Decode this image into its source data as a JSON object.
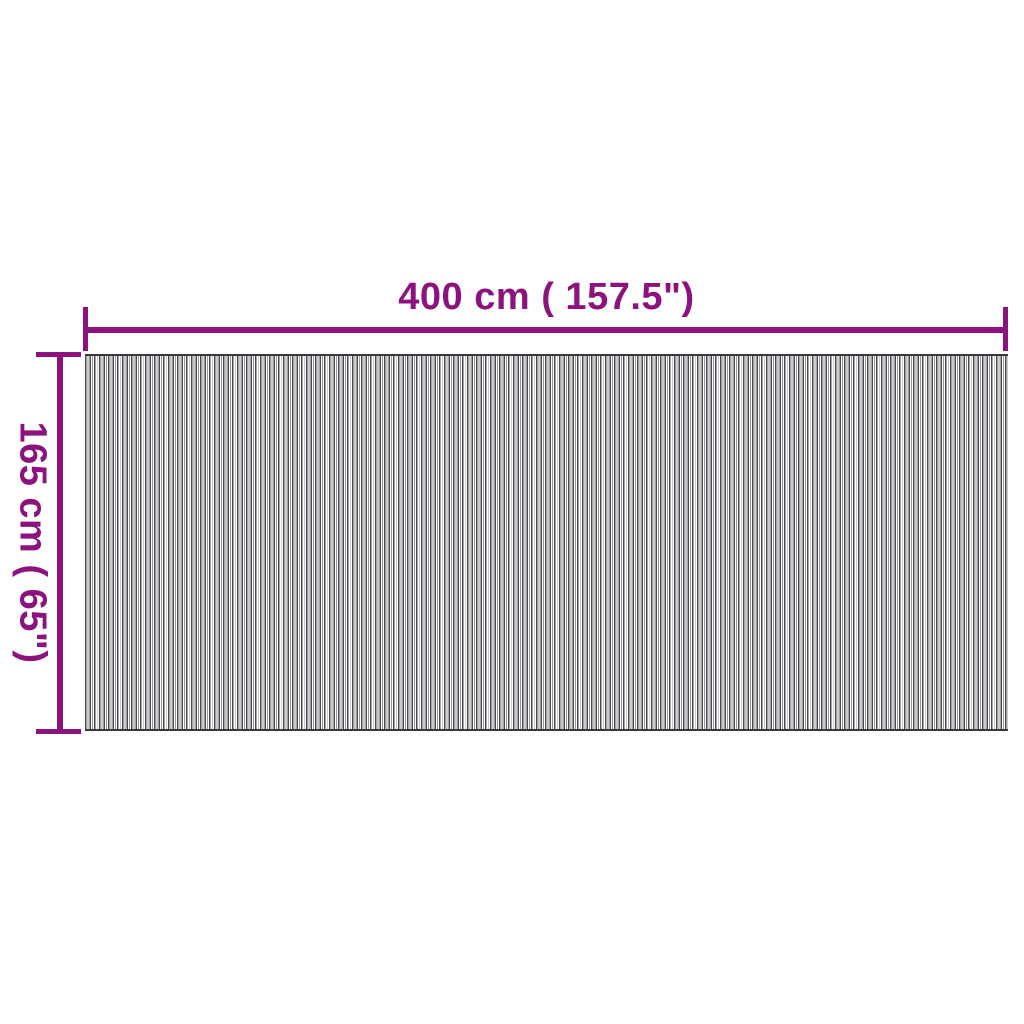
{
  "diagram": {
    "type": "product-dimension-diagram",
    "dimensions": {
      "width": {
        "label": "400 cm ( 157.5\")"
      },
      "height": {
        "label": "165 cm ( 65\")"
      }
    }
  },
  "colors": {
    "accent": "#8c127e",
    "stripe_dark": "#4a4a4e",
    "stripe_mid": "#97979b",
    "stripe_light": "#fdfdfd",
    "edge_dark": "#39393d"
  }
}
